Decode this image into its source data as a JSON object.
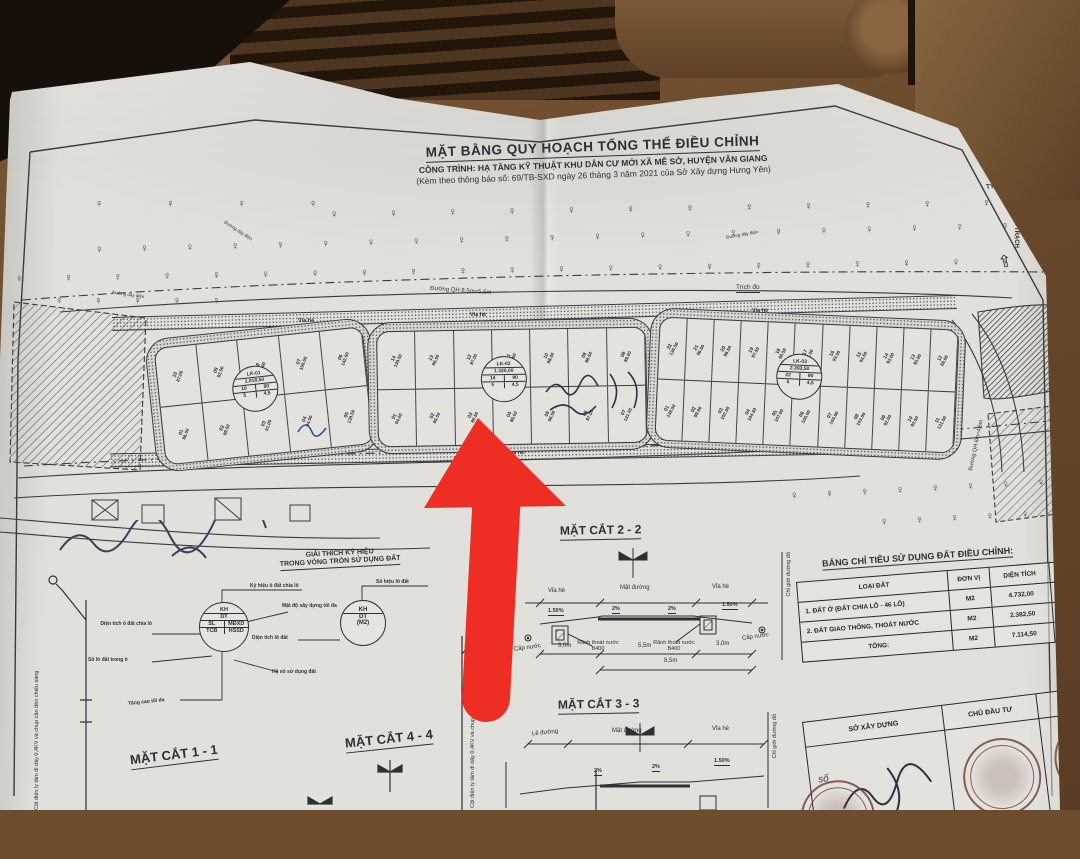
{
  "header": {
    "title": "MẶT BẰNG QUY HOẠCH TỔNG THỂ ĐIỀU CHỈNH",
    "project": "CÔNG TRÌNH: HẠ TẦNG KỸ THUẬT KHU DÂN CƯ MỚI XÃ MỄ SỞ, HUYỆN VĂN GIANG",
    "note": "(Kèm theo thông báo số: 69/TB-SXD ngày 26 tháng 3 năm 2021 của Sở Xây dựng Hưng Yên)"
  },
  "compass": {
    "scale": "TỶ LỆ 1/500",
    "direction": "ĐI QUÁN TRẠCH",
    "arrow": "⇧",
    "icon": "✵"
  },
  "trees": {
    "glyph": "♀",
    "row1": "♀ ♀ ♀ ♀ ♀ ♀ ♀ ♀ ♀ ♀ ♀ ♀ ♀ ♀ ♀ ♀ ♀ ♀ ♀ ♀ ♀",
    "row2": "♀ ♀ ♀ ♀ ♀ ♀ ♀ ♀ ♀ ♀ ♀ ♀ ♀ ♀ ♀ ♀ ♀ ♀ ♀ ♀ ♀ ♀ ♀ ♀",
    "row3": "♀ ♀ ♀ ♀ ♀ ♀ ♀ ♀ ♀ ♀ ♀ ♀ ♀ ♀ ♀ ♀ ♀ ♀ ♀ ♀ ♀ ♀ ♀ ♀ ♀ ♀",
    "cluster1": "♀ ♀ ♀ ♀",
    "cluster2": "♀ ♀ ♀ ♀ ♀",
    "row_bottom1": "♀ ♀ ♀ ♀ ♀ ♀ ♀ ♀ ♀",
    "row_bottom2": "♀ ♀ ♀ ♀ ♀"
  },
  "plan": {
    "road_top": "Đường QH 8,5m=5,5m",
    "road_bottom": "Đường QH 8,5m=5,5m",
    "road_side": "Đường QH 8m=4,5m",
    "sidewalk": "Vỉa hè",
    "trich_do": "Trích đo",
    "power_line": "Đường dây điện",
    "corner_marker": "12",
    "blocks": [
      {
        "kh": "LK-01",
        "dt": "1.018,50",
        "sl": "10",
        "mdxd": "90",
        "tcb": "5",
        "hssd": "4,5",
        "top": [
          {
            "id": "10",
            "area": "87.00"
          },
          {
            "id": "09",
            "area": "92.50"
          },
          {
            "id": "08",
            "area": "98.00"
          },
          {
            "id": "07",
            "area": "100.50"
          },
          {
            "id": "06",
            "area": "142.00"
          }
        ],
        "bottom": [
          {
            "id": "01",
            "area": "86.00"
          },
          {
            "id": "02",
            "area": "88.50"
          },
          {
            "id": "03",
            "area": "91.00"
          },
          {
            "id": "04",
            "area": "94.00"
          },
          {
            "id": "05",
            "area": "138.50"
          }
        ]
      },
      {
        "kh": "LK-02",
        "dt": "1.320,00",
        "sl": "14",
        "mdxd": "90",
        "tcb": "5",
        "hssd": "4,5",
        "top": [
          {
            "id": "14",
            "area": "138.50"
          },
          {
            "id": "13",
            "area": "86.50"
          },
          {
            "id": "12",
            "area": "87.00"
          },
          {
            "id": "11",
            "area": "87.50"
          },
          {
            "id": "10",
            "area": "88.00"
          },
          {
            "id": "09",
            "area": "88.50"
          },
          {
            "id": "08",
            "area": "89.00"
          }
        ],
        "bottom": [
          {
            "id": "01",
            "area": "94.00"
          },
          {
            "id": "02",
            "area": "85.00"
          },
          {
            "id": "03",
            "area": "85.50"
          },
          {
            "id": "04",
            "area": "86.00"
          },
          {
            "id": "05",
            "area": "86.50"
          },
          {
            "id": "06",
            "area": "87.00"
          },
          {
            "id": "07",
            "area": "131.00"
          }
        ]
      },
      {
        "kh": "LK-03",
        "dt": "2.393,50",
        "sl": "22",
        "mdxd": "90",
        "tcb": "5",
        "hssd": "4,5",
        "top": [
          {
            "id": "22",
            "area": "136.50"
          },
          {
            "id": "21",
            "area": "96.50"
          },
          {
            "id": "20",
            "area": "96.50"
          },
          {
            "id": "19",
            "area": "97.50"
          },
          {
            "id": "18",
            "area": "98.50"
          },
          {
            "id": "17",
            "area": "96.50"
          },
          {
            "id": "16",
            "area": "93.50"
          },
          {
            "id": "15",
            "area": "94.50"
          },
          {
            "id": "14",
            "area": "93.00"
          },
          {
            "id": "13",
            "area": "93.00"
          },
          {
            "id": "12",
            "area": "88.00"
          }
        ],
        "bottom": [
          {
            "id": "01",
            "area": "138.50"
          },
          {
            "id": "02",
            "area": "99.00"
          },
          {
            "id": "03",
            "area": "102.00"
          },
          {
            "id": "04",
            "area": "104.50"
          },
          {
            "id": "05",
            "area": "107.00"
          },
          {
            "id": "06",
            "area": "105.00"
          },
          {
            "id": "07",
            "area": "104.00"
          },
          {
            "id": "08",
            "area": "103.00"
          },
          {
            "id": "09",
            "area": "92.50"
          },
          {
            "id": "10",
            "area": "93.50"
          },
          {
            "id": "11",
            "area": "131.50"
          }
        ]
      }
    ]
  },
  "legend": {
    "heading1": "GIẢI THÍCH KÝ HIỆU",
    "heading2": "TRONG VÒNG TRÒN SỬ DỤNG ĐẤT",
    "c1": {
      "kh": "KH",
      "dt": "DT",
      "sl": "SL",
      "mdxd": "MĐXD",
      "tcb": "TCB",
      "hssd": "HSSD",
      "lbl_kh": "Ký hiệu ô đất chia lô",
      "lbl_mdxd": "Mật độ xây dựng tối đa",
      "lbl_dt": "Diện tích ô đất chia lô",
      "lbl_sl": "Số lô đất trong ô",
      "lbl_hssd": "Hệ số sử dụng đất",
      "lbl_tcb": "Tầng cao tối đa"
    },
    "c2": {
      "kh": "KH",
      "dt": "DT",
      "m2": "(M2)",
      "lbl_kh": "Số hiệu lô đất",
      "lbl_dt": "Diện tích lô đất"
    }
  },
  "sections": {
    "s22": {
      "title": "MẶT CẮT 2 - 2",
      "left_label": "Vỉa hè",
      "center_label": "Mặt đường",
      "right_label": "Vỉa hè",
      "slope_side": "1.50%",
      "slope_center": "2%",
      "gutter": "Rãnh thoát nước B400",
      "water": "Cấp nước",
      "dim_left": "3,0m",
      "dim_center": "5,5m",
      "dim_right": "3,0m",
      "dim_total": "8,5m",
      "red_line": "Chỉ giới đường đỏ"
    },
    "s33": {
      "title": "MẶT CẮT 3 - 3",
      "left_label": "Lề đường",
      "center_label": "Mặt đường",
      "right_label": "Vỉa hè",
      "slope_center": "2%",
      "slope_side": "1.50%",
      "red_line": "Chỉ giới đường đỏ"
    },
    "s11": {
      "title": "MẶT CẮT 1 - 1"
    },
    "s44": {
      "title": "MẶT CẮT 4 - 4"
    },
    "pole_label": "Cột điện ly tâm đi dây 0,4KV và chụp cần đèn chiếu sáng"
  },
  "table": {
    "title": "BẢNG CHỈ TIÊU SỬ DỤNG ĐẤT ĐIỀU CHỈNH:",
    "col_type": "LOẠI ĐẤT",
    "col_unit": "ĐƠN VỊ",
    "col_area": "DIỆN TÍCH",
    "col_pct": "TỶ LỆ",
    "rows": [
      {
        "name": "1. ĐẤT Ở (ĐẤT CHIA LÔ - 46 LÔ)",
        "unit": "M2",
        "area": "4.732,00",
        "pct": "66,5"
      },
      {
        "name": "2. ĐẤT GIAO THÔNG, THOÁT NƯỚC",
        "unit": "M2",
        "area": "2.382,50",
        "pct": "33,5"
      },
      {
        "name": "TỔNG:",
        "unit": "M2",
        "area": "7.114,50",
        "pct": "100"
      }
    ]
  },
  "signs": {
    "so_xay_dung": "SỞ XÂY DỰNG",
    "chu_dau_tu": "CHỦ ĐẦU TƯ",
    "don_vi": "ĐƠN VỊ TƯ VẤN",
    "so": "số"
  },
  "annotation": {
    "arrow_color": "#ee2d24",
    "target": "LK-02 lot 03"
  }
}
